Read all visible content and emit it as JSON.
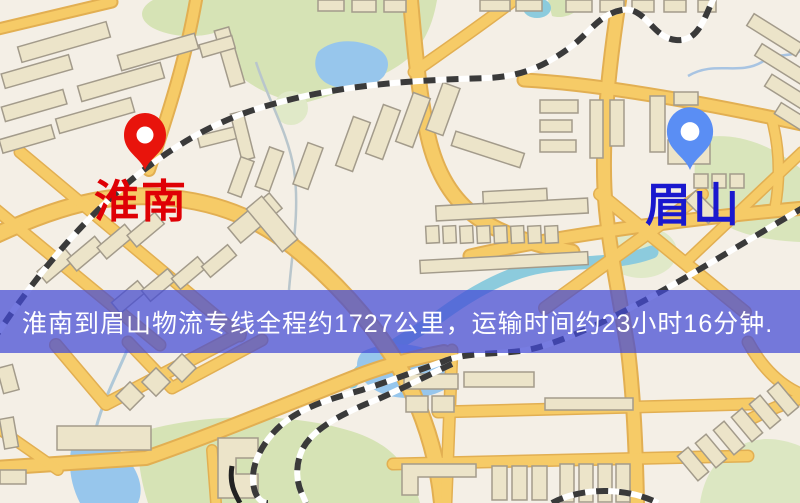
{
  "map": {
    "origin": {
      "label": "淮南",
      "pin_color": "#E8140C",
      "label_color": "#DF0005"
    },
    "destination": {
      "label": "眉山",
      "pin_color": "#5A8EF4",
      "label_color": "#1A18CE"
    },
    "banner": {
      "text": "淮南到眉山物流专线全程约1727公里，运输时间约23小时16分钟.",
      "text_color": "#FFFFFF",
      "bg_rgba": "rgba(67,73,214,0.72)"
    },
    "route": {
      "from": "淮南",
      "to": "眉山",
      "distance_km": 1727,
      "duration_hours": 23,
      "duration_minutes": 16
    },
    "theme": {
      "background": "#F4EFE6",
      "road_fill": "#F6CB67",
      "road_border": "#E2AF52",
      "building_fill": "#ECE4C9",
      "building_border": "#A39B8B",
      "green_area": "#D6E3B5",
      "water": "#97C6EC",
      "stream": "#8CCBDD",
      "railway": "#3A3A3A"
    }
  }
}
